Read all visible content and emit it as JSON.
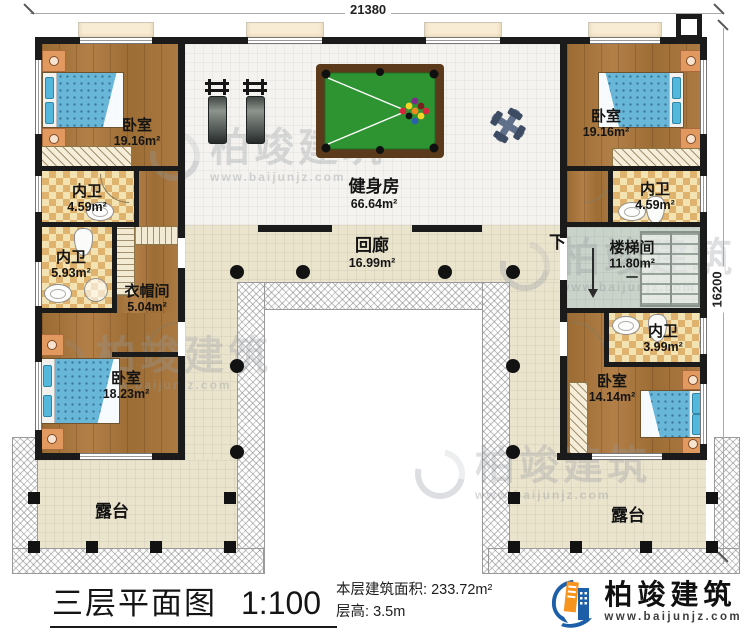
{
  "dim": {
    "top": "21380",
    "right": "16200"
  },
  "rooms": {
    "bedroom_tl": {
      "name": "卧室",
      "area": "19.16m²"
    },
    "bedroom_tr": {
      "name": "卧室",
      "area": "19.16m²"
    },
    "gym": {
      "name": "健身房",
      "area": "66.64m²"
    },
    "bath_tl": {
      "name": "内卫",
      "area": "4.59m²"
    },
    "bath_l": {
      "name": "内卫",
      "area": "5.93m²"
    },
    "cloak": {
      "name": "衣帽间",
      "area": "5.04m²"
    },
    "corridor": {
      "name": "回廊",
      "area": "16.99m²"
    },
    "stair": {
      "name": "楼梯间",
      "area": "11.80m²",
      "mark": "一",
      "down": "下"
    },
    "bath_tr": {
      "name": "内卫",
      "area": "4.59m²"
    },
    "bath_br": {
      "name": "内卫",
      "area": "3.99m²"
    },
    "bedroom_bl": {
      "name": "卧室",
      "area": "18.23m²"
    },
    "bedroom_br": {
      "name": "卧室",
      "area": "14.14m²"
    },
    "terrace_l": {
      "name": "露台"
    },
    "terrace_r": {
      "name": "露台"
    }
  },
  "titlebar": {
    "title": "三层平面图",
    "scale": "1:100",
    "area_label": "本层建筑面积:",
    "area_value": "233.72m²",
    "floor_height_label": "层高:",
    "floor_height_value": "3.5m"
  },
  "brand": {
    "name": "柏竣建筑",
    "url": "www.baijunjz.com"
  },
  "watermark": {
    "text": "柏竣建筑",
    "url": "www.baijunjz.com"
  },
  "colors": {
    "wall": "#1b1b1b",
    "wood": "#a5743c",
    "tile_dark": "#dfb26e",
    "tile_light": "#f4e3b2",
    "gym_floor": "#f4f3ef",
    "corridor_floor": "#ebe4cd",
    "stair_floor": "#c9d3c9",
    "bed_blue": "#68b7d9",
    "pool_felt": "#2e9331",
    "brand_blue": "#1c5fa8",
    "brand_orange": "#f7941d"
  }
}
